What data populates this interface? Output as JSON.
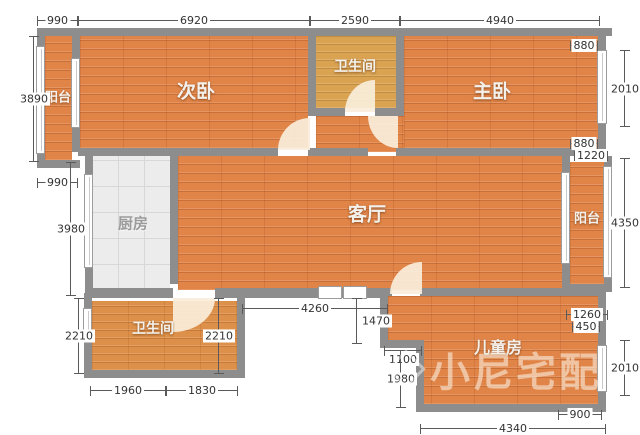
{
  "title": "apartment floor plan",
  "rooms": [
    {
      "id": "balcony-top-left",
      "label": "阳台"
    },
    {
      "id": "bedroom-second",
      "label": "次卧"
    },
    {
      "id": "bathroom-top",
      "label": "卫生间"
    },
    {
      "id": "bedroom-master",
      "label": "主卧"
    },
    {
      "id": "kitchen",
      "label": "厨房"
    },
    {
      "id": "living-room",
      "label": "客厅"
    },
    {
      "id": "balcony-right",
      "label": "阳台"
    },
    {
      "id": "bathroom-bottom",
      "label": "卫生间"
    },
    {
      "id": "kids-room",
      "label": "儿童房"
    }
  ],
  "dims": [
    {
      "label": "990",
      "side": "top"
    },
    {
      "label": "6920",
      "side": "top"
    },
    {
      "label": "2590",
      "side": "top"
    },
    {
      "label": "4940",
      "side": "top"
    },
    {
      "label": "880",
      "side": "right"
    },
    {
      "label": "2010",
      "side": "right"
    },
    {
      "label": "880",
      "side": "right"
    },
    {
      "label": "1220",
      "side": "right"
    },
    {
      "label": "4350",
      "side": "right"
    },
    {
      "label": "1260",
      "side": "right"
    },
    {
      "label": "450",
      "side": "right"
    },
    {
      "label": "2010",
      "side": "right"
    },
    {
      "label": "900",
      "side": "right"
    },
    {
      "label": "3890",
      "side": "left"
    },
    {
      "label": "990",
      "side": "left"
    },
    {
      "label": "3980",
      "side": "left"
    },
    {
      "label": "2210",
      "side": "left"
    },
    {
      "label": "1960",
      "side": "bottom"
    },
    {
      "label": "1830",
      "side": "bottom"
    },
    {
      "label": "4260",
      "side": "interior-bottom"
    },
    {
      "label": "2210",
      "side": "interior-bottom"
    },
    {
      "label": "1470",
      "side": "interior-bottom"
    },
    {
      "label": "1100",
      "side": "interior-bottom"
    },
    {
      "label": "1980",
      "side": "interior-bottom"
    },
    {
      "label": "4340",
      "side": "bottom"
    }
  ],
  "watermark": {
    "text": "小尼宅配"
  },
  "colors": {
    "wall": "#8d8d8d",
    "floor_wood": "#e08448",
    "floor_tile": "#ececec",
    "floor_bath_top": "#d9a352",
    "floor_bath_bottom": "#dd9049",
    "dim_text": "#333333",
    "room_label": "#f4f1ec",
    "watermark": "rgba(255,255,255,0.48)"
  }
}
